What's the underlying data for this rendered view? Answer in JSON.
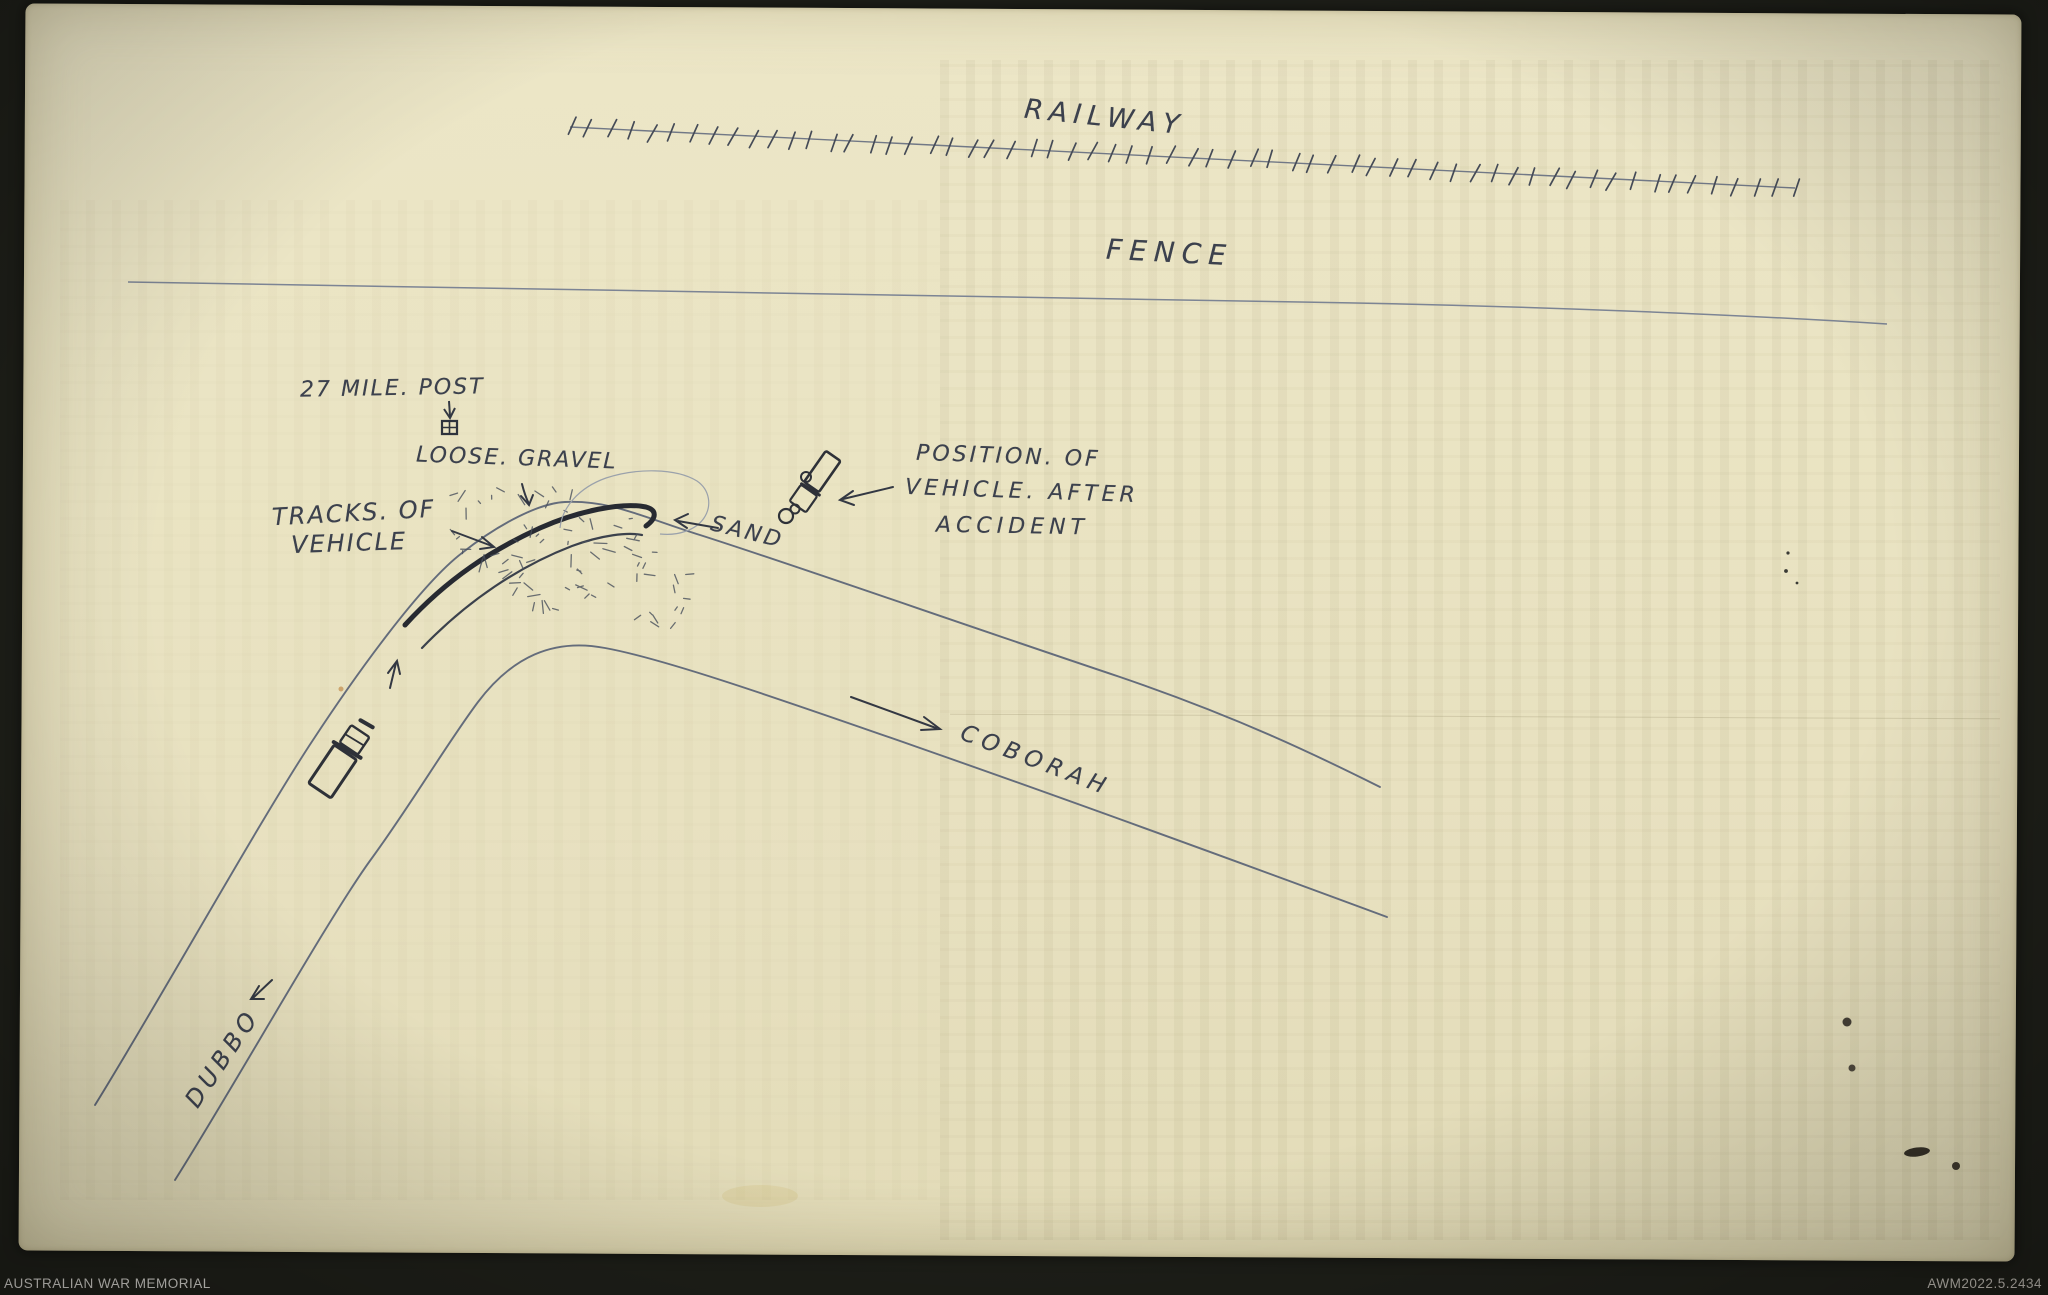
{
  "archive": {
    "institution": "AUSTRALIAN WAR MEMORIAL",
    "catalog_number": "AWM2022.5.2434"
  },
  "diagram": {
    "type": "hand-drawn accident scene sketch map",
    "labels": {
      "railway": "RAILWAY",
      "fence": "FENCE",
      "mile_post": "27 MILE. POST",
      "loose_gravel": "LOOSE. GRAVEL",
      "tracks_of_vehicle": {
        "line1": "TRACKS. OF",
        "line2": "VEHICLE"
      },
      "sand": "SAND",
      "vehicle_position": {
        "line1": "POSITION. OF",
        "line2": "VEHICLE. AFTER",
        "line3": "ACCIDENT"
      },
      "road_to": "COBORAH",
      "road_from": "DUBBO"
    },
    "symbols": {
      "railway_track": "hatched-line",
      "mile_post_marker": "down-arrow-over-crossed-square",
      "vehicle_on_road": "truck-plan-sketch",
      "vehicle_after_accident": "overturned-truck-sketch",
      "direction_arrows": "hand-drawn-arrows"
    },
    "colors": {
      "background": "#1d1e18",
      "paper": "#eae4c3",
      "ink": "#3c414d",
      "track_ink": "#272a31",
      "road_line": "#646c7b",
      "footer_text": "#c9c7c2"
    }
  }
}
